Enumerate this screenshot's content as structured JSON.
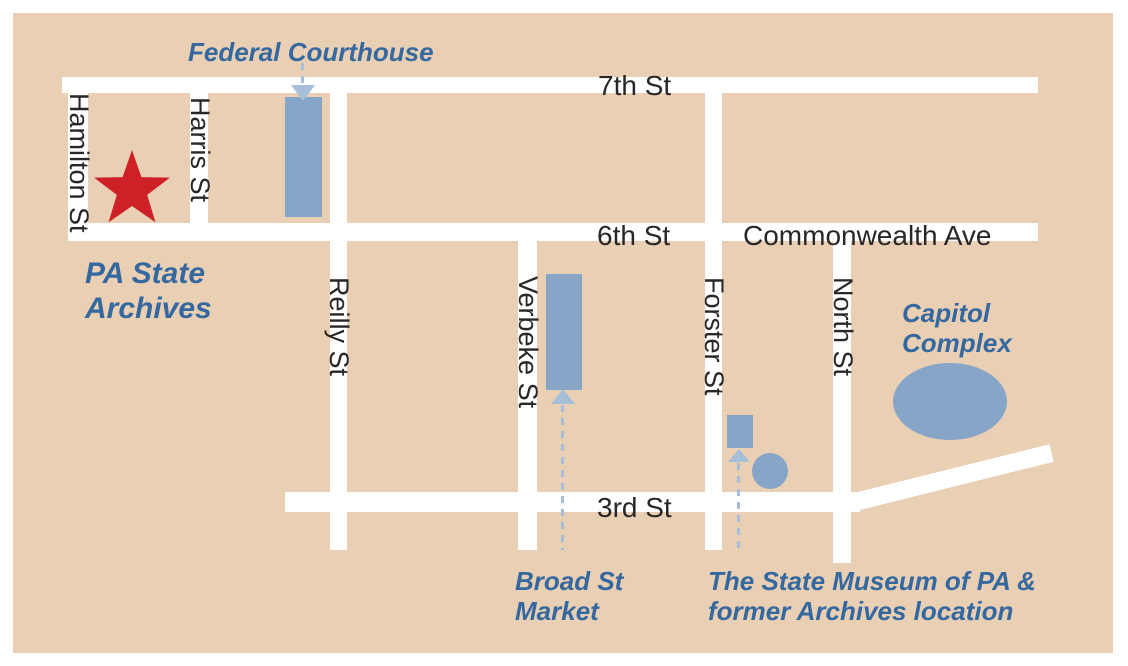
{
  "colors": {
    "land": "#e9d0b5",
    "street": "#ffffff",
    "building_blue": "#87a5c6",
    "annotation_blue": "#35689f",
    "street_label_black": "#2a2526",
    "star_red": "#ce2127",
    "arrow_light_blue": "#a6bed8"
  },
  "streets": {
    "seventh": "7th St",
    "sixth": "6th St",
    "commonwealth": "Commonwealth Ave",
    "third": "3rd St",
    "hamilton": "Hamilton St",
    "harris": "Harris St",
    "reilly": "Reilly St",
    "verbeke": "Verbeke St",
    "forster": "Forster St",
    "north": "North St"
  },
  "places": {
    "federal_courthouse": {
      "label": "Federal Courthouse",
      "marker": "blue-rectangle-building"
    },
    "pa_state_archives": {
      "line1": "PA State",
      "line2": "Archives",
      "marker": "red-star"
    },
    "capitol_complex": {
      "line1": "Capitol",
      "line2": "Complex",
      "marker": "blue-ellipse"
    },
    "broad_st_market": {
      "line1": "Broad St",
      "line2": "Market",
      "marker": "blue-rectangle-building"
    },
    "state_museum": {
      "line1": "The State Museum of PA &",
      "line2": "former Archives location",
      "marker": "blue-rectangle-and-circle"
    }
  }
}
